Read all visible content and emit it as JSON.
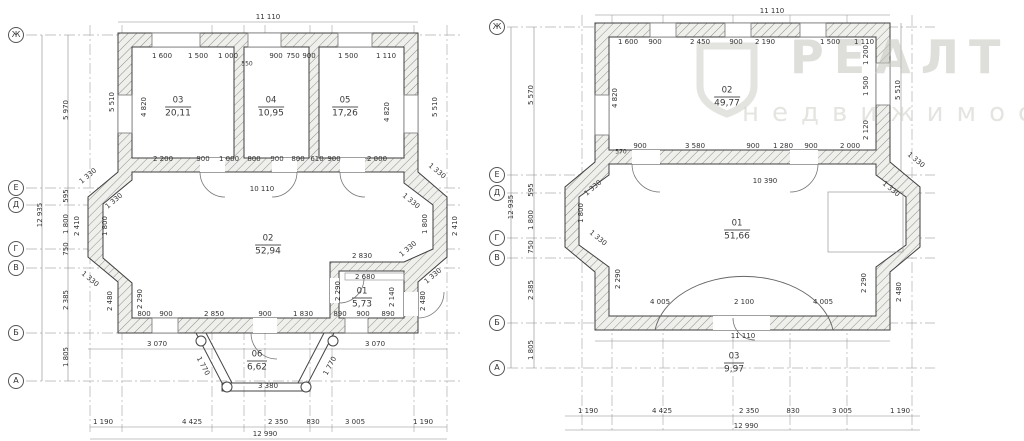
{
  "watermark": {
    "brand": "РЕАЛТ",
    "tagline": "недвижимость"
  },
  "plans": [
    {
      "id": "plan-1",
      "axes": [
        {
          "label": "Ж",
          "x": 16,
          "y": 35
        },
        {
          "label": "Е",
          "x": 16,
          "y": 188
        },
        {
          "label": "Д",
          "x": 16,
          "y": 205
        },
        {
          "label": "Г",
          "x": 16,
          "y": 249
        },
        {
          "label": "В",
          "x": 16,
          "y": 268
        },
        {
          "label": "Б",
          "x": 16,
          "y": 333
        },
        {
          "label": "А",
          "x": 16,
          "y": 381
        }
      ],
      "rooms": [
        {
          "num": "03",
          "area": "20,11",
          "x": 178,
          "y": 107
        },
        {
          "num": "04",
          "area": "10,95",
          "x": 271,
          "y": 107
        },
        {
          "num": "05",
          "area": "17,26",
          "x": 345,
          "y": 107
        },
        {
          "num": "02",
          "area": "52,94",
          "x": 268,
          "y": 245
        },
        {
          "num": "01",
          "area": "5,73",
          "x": 362,
          "y": 298
        },
        {
          "num": "06",
          "area": "6,62",
          "x": 257,
          "y": 361
        }
      ],
      "dims": [
        {
          "t": "11 110",
          "x": 268,
          "y": 17
        },
        {
          "t": "1 600",
          "x": 162,
          "y": 56
        },
        {
          "t": "1 500",
          "x": 198,
          "y": 56
        },
        {
          "t": "1 000",
          "x": 228,
          "y": 56
        },
        {
          "t": "550",
          "x": 247,
          "y": 64,
          "s": 6
        },
        {
          "t": "900",
          "x": 276,
          "y": 56
        },
        {
          "t": "750",
          "x": 293,
          "y": 56
        },
        {
          "t": "900",
          "x": 309,
          "y": 56
        },
        {
          "t": "1 500",
          "x": 348,
          "y": 56
        },
        {
          "t": "1 110",
          "x": 386,
          "y": 56
        },
        {
          "t": "12 935",
          "x": 40,
          "y": 215,
          "r": -90
        },
        {
          "t": "5 970",
          "x": 66,
          "y": 110,
          "r": -90
        },
        {
          "t": "595",
          "x": 66,
          "y": 196,
          "r": -90
        },
        {
          "t": "1 800",
          "x": 66,
          "y": 224,
          "r": -90
        },
        {
          "t": "750",
          "x": 66,
          "y": 249,
          "r": -90
        },
        {
          "t": "2 385",
          "x": 66,
          "y": 300,
          "r": -90
        },
        {
          "t": "1 805",
          "x": 66,
          "y": 357,
          "r": -90
        },
        {
          "t": "5 510",
          "x": 112,
          "y": 102,
          "r": -90
        },
        {
          "t": "4 820",
          "x": 144,
          "y": 107,
          "r": -90
        },
        {
          "t": "5 510",
          "x": 435,
          "y": 107,
          "r": -90
        },
        {
          "t": "4 820",
          "x": 387,
          "y": 112,
          "r": -90
        },
        {
          "t": "1 330",
          "x": 88,
          "y": 176,
          "r": -40
        },
        {
          "t": "1 330",
          "x": 114,
          "y": 201,
          "r": -40
        },
        {
          "t": "1 330",
          "x": 90,
          "y": 279,
          "r": 40
        },
        {
          "t": "2 410",
          "x": 77,
          "y": 226,
          "r": -90
        },
        {
          "t": "1 800",
          "x": 105,
          "y": 226,
          "r": -90
        },
        {
          "t": "2 480",
          "x": 110,
          "y": 301,
          "r": -90
        },
        {
          "t": "2 290",
          "x": 140,
          "y": 299,
          "r": -90
        },
        {
          "t": "1 330",
          "x": 437,
          "y": 171,
          "r": 40
        },
        {
          "t": "1 330",
          "x": 411,
          "y": 201,
          "r": 40
        },
        {
          "t": "1 330",
          "x": 408,
          "y": 249,
          "r": -40
        },
        {
          "t": "1 330",
          "x": 433,
          "y": 276,
          "r": -40
        },
        {
          "t": "1 800",
          "x": 425,
          "y": 224,
          "r": -90
        },
        {
          "t": "2 410",
          "x": 455,
          "y": 226,
          "r": -90
        },
        {
          "t": "2 200",
          "x": 163,
          "y": 159
        },
        {
          "t": "900",
          "x": 203,
          "y": 159
        },
        {
          "t": "1 000",
          "x": 229,
          "y": 159
        },
        {
          "t": "800",
          "x": 254,
          "y": 159
        },
        {
          "t": "900",
          "x": 277,
          "y": 159
        },
        {
          "t": "800",
          "x": 298,
          "y": 159
        },
        {
          "t": "610",
          "x": 317,
          "y": 159
        },
        {
          "t": "900",
          "x": 334,
          "y": 159
        },
        {
          "t": "2 000",
          "x": 377,
          "y": 159
        },
        {
          "t": "10 110",
          "x": 262,
          "y": 189
        },
        {
          "t": "2 830",
          "x": 362,
          "y": 256
        },
        {
          "t": "2 680",
          "x": 365,
          "y": 277
        },
        {
          "t": "2 290",
          "x": 338,
          "y": 291,
          "r": -90
        },
        {
          "t": "2 140",
          "x": 392,
          "y": 297,
          "r": -90
        },
        {
          "t": "2 480",
          "x": 423,
          "y": 301,
          "r": -90
        },
        {
          "t": "800",
          "x": 144,
          "y": 314
        },
        {
          "t": "900",
          "x": 166,
          "y": 314
        },
        {
          "t": "2 850",
          "x": 214,
          "y": 314
        },
        {
          "t": "900",
          "x": 265,
          "y": 314
        },
        {
          "t": "1 830",
          "x": 303,
          "y": 314
        },
        {
          "t": "890",
          "x": 340,
          "y": 314
        },
        {
          "t": "900",
          "x": 363,
          "y": 314
        },
        {
          "t": "890",
          "x": 388,
          "y": 314
        },
        {
          "t": "3 070",
          "x": 157,
          "y": 344
        },
        {
          "t": "3 070",
          "x": 375,
          "y": 344
        },
        {
          "t": "1 770",
          "x": 203,
          "y": 366,
          "r": 62
        },
        {
          "t": "1 770",
          "x": 330,
          "y": 366,
          "r": -62
        },
        {
          "t": "3 380",
          "x": 268,
          "y": 386
        },
        {
          "t": "1 190",
          "x": 103,
          "y": 422
        },
        {
          "t": "4 425",
          "x": 192,
          "y": 422
        },
        {
          "t": "2 350",
          "x": 278,
          "y": 422
        },
        {
          "t": "830",
          "x": 313,
          "y": 422
        },
        {
          "t": "3 005",
          "x": 355,
          "y": 422
        },
        {
          "t": "1 190",
          "x": 423,
          "y": 422
        },
        {
          "t": "12 990",
          "x": 265,
          "y": 434
        }
      ]
    },
    {
      "id": "plan-2",
      "axes": [
        {
          "label": "Ж",
          "x": 497,
          "y": 27
        },
        {
          "label": "Е",
          "x": 497,
          "y": 175
        },
        {
          "label": "Д",
          "x": 497,
          "y": 193
        },
        {
          "label": "Г",
          "x": 497,
          "y": 238
        },
        {
          "label": "В",
          "x": 497,
          "y": 258
        },
        {
          "label": "Б",
          "x": 497,
          "y": 323
        },
        {
          "label": "А",
          "x": 497,
          "y": 368
        }
      ],
      "rooms": [
        {
          "num": "02",
          "area": "49,77",
          "x": 727,
          "y": 97
        },
        {
          "num": "01",
          "area": "51,66",
          "x": 737,
          "y": 230
        },
        {
          "num": "03",
          "area": "9,97",
          "x": 734,
          "y": 363
        }
      ],
      "dims": [
        {
          "t": "11 110",
          "x": 772,
          "y": 11
        },
        {
          "t": "1 600",
          "x": 628,
          "y": 42
        },
        {
          "t": "900",
          "x": 655,
          "y": 42
        },
        {
          "t": "2 450",
          "x": 700,
          "y": 42
        },
        {
          "t": "900",
          "x": 736,
          "y": 42
        },
        {
          "t": "2 190",
          "x": 765,
          "y": 42
        },
        {
          "t": "1 500",
          "x": 830,
          "y": 42
        },
        {
          "t": "1 110",
          "x": 864,
          "y": 42
        },
        {
          "t": "12 935",
          "x": 511,
          "y": 207,
          "r": -90
        },
        {
          "t": "5 570",
          "x": 531,
          "y": 95,
          "r": -90
        },
        {
          "t": "595",
          "x": 531,
          "y": 190,
          "r": -90
        },
        {
          "t": "1 800",
          "x": 531,
          "y": 220,
          "r": -90
        },
        {
          "t": "750",
          "x": 531,
          "y": 247,
          "r": -90
        },
        {
          "t": "2 385",
          "x": 531,
          "y": 290,
          "r": -90
        },
        {
          "t": "1 805",
          "x": 531,
          "y": 350,
          "r": -90
        },
        {
          "t": "4 820",
          "x": 615,
          "y": 98,
          "r": -90
        },
        {
          "t": "570",
          "x": 621,
          "y": 152,
          "s": 6
        },
        {
          "t": "900",
          "x": 640,
          "y": 146
        },
        {
          "t": "3 580",
          "x": 695,
          "y": 146
        },
        {
          "t": "900",
          "x": 753,
          "y": 146
        },
        {
          "t": "1 280",
          "x": 783,
          "y": 146
        },
        {
          "t": "900",
          "x": 811,
          "y": 146
        },
        {
          "t": "2 000",
          "x": 850,
          "y": 146
        },
        {
          "t": "10 390",
          "x": 765,
          "y": 181
        },
        {
          "t": "1 200",
          "x": 866,
          "y": 55,
          "r": -90
        },
        {
          "t": "1 500",
          "x": 866,
          "y": 86,
          "r": -90
        },
        {
          "t": "2 120",
          "x": 866,
          "y": 130,
          "r": -90
        },
        {
          "t": "5 510",
          "x": 898,
          "y": 90,
          "r": -90
        },
        {
          "t": "1 330",
          "x": 593,
          "y": 188,
          "r": -40
        },
        {
          "t": "1 330",
          "x": 598,
          "y": 238,
          "r": 40
        },
        {
          "t": "1 800",
          "x": 581,
          "y": 213,
          "r": -90
        },
        {
          "t": "2 290",
          "x": 618,
          "y": 279,
          "r": -90
        },
        {
          "t": "1 330",
          "x": 916,
          "y": 160,
          "r": 40
        },
        {
          "t": "1 330",
          "x": 891,
          "y": 189,
          "r": 40
        },
        {
          "t": "2 290",
          "x": 864,
          "y": 283,
          "r": -90
        },
        {
          "t": "2 480",
          "x": 899,
          "y": 292,
          "r": -90
        },
        {
          "t": "4 005",
          "x": 660,
          "y": 302
        },
        {
          "t": "2 100",
          "x": 744,
          "y": 302
        },
        {
          "t": "4 005",
          "x": 823,
          "y": 302
        },
        {
          "t": "11 110",
          "x": 743,
          "y": 336
        },
        {
          "t": "1 190",
          "x": 588,
          "y": 411
        },
        {
          "t": "4 425",
          "x": 662,
          "y": 411
        },
        {
          "t": "2 350",
          "x": 749,
          "y": 411
        },
        {
          "t": "830",
          "x": 793,
          "y": 411
        },
        {
          "t": "3 005",
          "x": 842,
          "y": 411
        },
        {
          "t": "1 190",
          "x": 900,
          "y": 411
        },
        {
          "t": "12 990",
          "x": 746,
          "y": 426
        }
      ]
    }
  ]
}
